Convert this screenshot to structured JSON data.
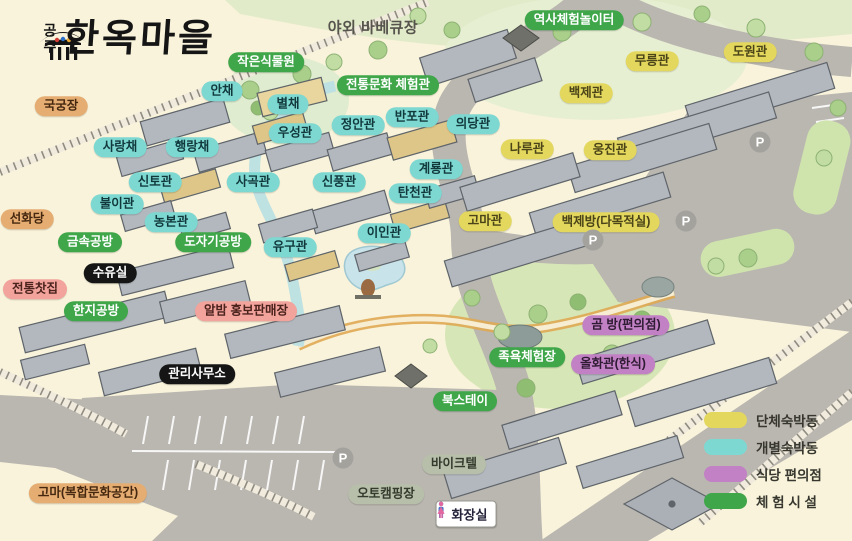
{
  "logo": {
    "site": "공주",
    "title": "한옥마을"
  },
  "label_styles": {
    "group": {
      "bg": "#e3d75e",
      "fg": "#4a4418"
    },
    "individual": {
      "bg": "#7ed8d2",
      "fg": "#11393c"
    },
    "food": {
      "bg": "#c181c4",
      "fg": "#2f1b33"
    },
    "experience": {
      "bg": "#3fa64a",
      "fg": "#ffffff"
    },
    "orange": {
      "bg": "#e5ad72",
      "fg": "#45280f"
    },
    "pink": {
      "bg": "#f2a39c",
      "fg": "#4b221c"
    },
    "black": {
      "bg": "#151515",
      "fg": "#ffffff"
    },
    "gray": {
      "bg": "#b7bfaa",
      "fg": "#343b2d"
    },
    "plain": {
      "bg": "transparent",
      "fg": "#56544c"
    }
  },
  "labels": [
    {
      "id": "outdoor-bbq",
      "text": "야외 바베큐장",
      "type": "plain",
      "x": 373,
      "y": 28
    },
    {
      "id": "history-play",
      "text": "역사체험놀이터",
      "type": "experience",
      "x": 574,
      "y": 20
    },
    {
      "id": "small-garden",
      "text": "작은식물원",
      "type": "experience",
      "x": 266,
      "y": 62
    },
    {
      "id": "mureung",
      "text": "무릉관",
      "type": "group",
      "x": 652,
      "y": 61
    },
    {
      "id": "dowon",
      "text": "도원관",
      "type": "group",
      "x": 750,
      "y": 52
    },
    {
      "id": "gukgung",
      "text": "국궁장",
      "type": "orange",
      "x": 61,
      "y": 106
    },
    {
      "id": "anchae",
      "text": "안채",
      "type": "individual",
      "x": 222,
      "y": 91
    },
    {
      "id": "byeolchae",
      "text": "별채",
      "type": "individual",
      "x": 288,
      "y": 104
    },
    {
      "id": "tradition-center",
      "text": "전통문화 체험관",
      "type": "experience",
      "x": 388,
      "y": 85
    },
    {
      "id": "baekje",
      "text": "백제관",
      "type": "group",
      "x": 586,
      "y": 93
    },
    {
      "id": "jeongan",
      "text": "정안관",
      "type": "individual",
      "x": 358,
      "y": 125
    },
    {
      "id": "banpo",
      "text": "반포관",
      "type": "individual",
      "x": 412,
      "y": 117
    },
    {
      "id": "uidang",
      "text": "의당관",
      "type": "individual",
      "x": 473,
      "y": 124
    },
    {
      "id": "sarangchae",
      "text": "사랑채",
      "type": "individual",
      "x": 120,
      "y": 147
    },
    {
      "id": "haengrangchae",
      "text": "행랑채",
      "type": "individual",
      "x": 192,
      "y": 147
    },
    {
      "id": "useong",
      "text": "우성관",
      "type": "individual",
      "x": 295,
      "y": 133
    },
    {
      "id": "naru",
      "text": "나루관",
      "type": "group",
      "x": 527,
      "y": 149
    },
    {
      "id": "ungjin",
      "text": "웅진관",
      "type": "group",
      "x": 610,
      "y": 150
    },
    {
      "id": "sinto",
      "text": "신토관",
      "type": "individual",
      "x": 155,
      "y": 182
    },
    {
      "id": "sagok",
      "text": "사곡관",
      "type": "individual",
      "x": 253,
      "y": 182
    },
    {
      "id": "sinpung",
      "text": "신풍관",
      "type": "individual",
      "x": 339,
      "y": 182
    },
    {
      "id": "gyeryong",
      "text": "계룡관",
      "type": "individual",
      "x": 436,
      "y": 169
    },
    {
      "id": "tancheon",
      "text": "탄천관",
      "type": "individual",
      "x": 415,
      "y": 193
    },
    {
      "id": "buli",
      "text": "불이관",
      "type": "individual",
      "x": 117,
      "y": 204
    },
    {
      "id": "seonhwadang",
      "text": "선화당",
      "type": "orange",
      "x": 27,
      "y": 219
    },
    {
      "id": "nongbon",
      "text": "농본관",
      "type": "individual",
      "x": 171,
      "y": 222
    },
    {
      "id": "goma-hall",
      "text": "고마관",
      "type": "group",
      "x": 485,
      "y": 221
    },
    {
      "id": "baekjebang",
      "text": "백제방(다목적실)",
      "type": "group",
      "x": 606,
      "y": 222
    },
    {
      "id": "metal-workshop",
      "text": "금속공방",
      "type": "experience",
      "x": 90,
      "y": 242
    },
    {
      "id": "pottery-workshop",
      "text": "도자기공방",
      "type": "experience",
      "x": 213,
      "y": 242
    },
    {
      "id": "iin",
      "text": "이인관",
      "type": "individual",
      "x": 384,
      "y": 233
    },
    {
      "id": "yugu",
      "text": "유구관",
      "type": "individual",
      "x": 290,
      "y": 247
    },
    {
      "id": "nursing-room",
      "text": "수유실",
      "type": "black",
      "x": 110,
      "y": 273
    },
    {
      "id": "tea-house",
      "text": "전통찻집",
      "type": "pink",
      "x": 35,
      "y": 289
    },
    {
      "id": "hanji-workshop",
      "text": "한지공방",
      "type": "experience",
      "x": 96,
      "y": 311
    },
    {
      "id": "albam-shop",
      "text": "알밤 홍보판매장",
      "type": "pink",
      "x": 246,
      "y": 311
    },
    {
      "id": "gom-bang",
      "text": "곰 방(편의점)",
      "type": "food",
      "x": 626,
      "y": 325
    },
    {
      "id": "foot-bath",
      "text": "족욕체험장",
      "type": "experience",
      "x": 527,
      "y": 357
    },
    {
      "id": "olhwagwan",
      "text": "올화관(한식)",
      "type": "food",
      "x": 613,
      "y": 364
    },
    {
      "id": "office",
      "text": "관리사무소",
      "type": "black",
      "x": 197,
      "y": 374
    },
    {
      "id": "book-stay",
      "text": "북스테이",
      "type": "experience",
      "x": 465,
      "y": 401
    },
    {
      "id": "biketel",
      "text": "바이크텔",
      "type": "gray",
      "x": 454,
      "y": 464
    },
    {
      "id": "auto-camping",
      "text": "오토캠핑장",
      "type": "gray",
      "x": 386,
      "y": 494
    },
    {
      "id": "goma-culture",
      "text": "고마(복합문화공간)",
      "type": "orange",
      "x": 88,
      "y": 493
    }
  ],
  "legend": {
    "items": [
      {
        "label": "단체숙박동",
        "type": "group"
      },
      {
        "label": "개별숙박동",
        "type": "individual"
      },
      {
        "label": "식당 편의점",
        "type": "food"
      },
      {
        "label": "체 험 시 설",
        "type": "experience"
      }
    ]
  },
  "parking": {
    "glyph": "P",
    "spots": [
      {
        "x": 760,
        "y": 142
      },
      {
        "x": 686,
        "y": 221
      },
      {
        "x": 593,
        "y": 240
      },
      {
        "x": 343,
        "y": 458
      }
    ]
  },
  "toilet": {
    "label": "화장실",
    "x": 466,
    "y": 514,
    "man_color": "#4a73c9",
    "woman_color": "#e2679e"
  }
}
